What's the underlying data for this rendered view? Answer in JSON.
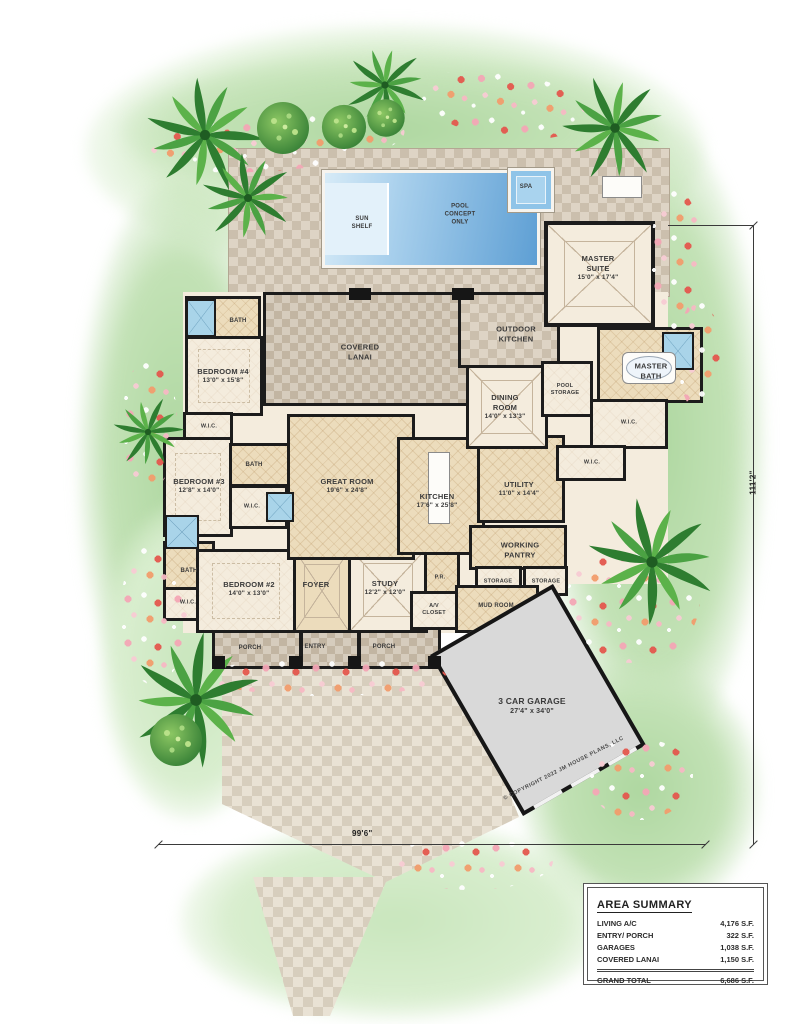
{
  "plan": {
    "pool": {
      "sun_shelf": "SUN\nSHELF",
      "concept": "POOL\nCONCEPT\nONLY",
      "spa": "SPA"
    },
    "rooms": {
      "master_suite": {
        "name": "MASTER\nSUITE",
        "dims": "15'0\" x 17'4\""
      },
      "bedroom4": {
        "name": "BEDROOM #4",
        "dims": "13'0\" x 15'8\""
      },
      "bedroom3": {
        "name": "BEDROOM #3",
        "dims": "12'8\" x 14'0\""
      },
      "bedroom2": {
        "name": "BEDROOM #2",
        "dims": "14'0\" x 13'0\""
      },
      "great_room": {
        "name": "GREAT ROOM",
        "dims": "19'6\" x 24'8\""
      },
      "kitchen": {
        "name": "KITCHEN",
        "dims": "17'6\" x 25'8\""
      },
      "dining_room": {
        "name": "DINING\nROOM",
        "dims": "14'0\" x 13'3\""
      },
      "utility": {
        "name": "UTILITY",
        "dims": "11'0\" x 14'4\""
      },
      "study": {
        "name": "STUDY",
        "dims": "12'2\" x 12'0\""
      },
      "garage": {
        "name": "3 CAR GARAGE",
        "dims": "27'4\" x 34'0\""
      },
      "covered_lanai": {
        "name": "COVERED\nLANAI"
      },
      "outdoor_kitchen": {
        "name": "OUTDOOR\nKITCHEN"
      },
      "master_bath": {
        "name": "MASTER\nBATH"
      },
      "pool_storage": {
        "name": "POOL\nSTORAGE"
      },
      "working_pantry": {
        "name": "WORKING\nPANTRY"
      },
      "mud_room": {
        "name": "MUD ROOM"
      },
      "foyer": {
        "name": "FOYER"
      },
      "pr": {
        "name": "P.R."
      },
      "av_closet": {
        "name": "A/V\nCLOSET"
      }
    },
    "labels": {
      "bath": "BATH",
      "wic": "W.I.C.",
      "porch": "PORCH",
      "entry": "ENTRY",
      "storage": "STORAGE"
    },
    "dimensions": {
      "width": "99'6\"",
      "height": "111'2\""
    },
    "copyright": "© COPYRIGHT 2022 JM HOUSE PLANS, LLC",
    "area_summary": {
      "title": "AREA SUMMARY",
      "rows": [
        {
          "label": "LIVING A/C",
          "value": "4,176 S.F."
        },
        {
          "label": "ENTRY/ PORCH",
          "value": "322 S.F."
        },
        {
          "label": "GARAGES",
          "value": "1,038 S.F."
        },
        {
          "label": "COVERED LANAI",
          "value": "1,150 S.F."
        }
      ],
      "total": {
        "label": "GRAND TOTAL",
        "value": "6,686 S.F."
      }
    },
    "colors": {
      "pool_blue": "#5e9fd4",
      "landscape_green": "#b7dcab",
      "deck_tan": "#ded4c5",
      "wall_black": "#1c1c1c",
      "garage_gray": "#d9d9d9"
    }
  }
}
